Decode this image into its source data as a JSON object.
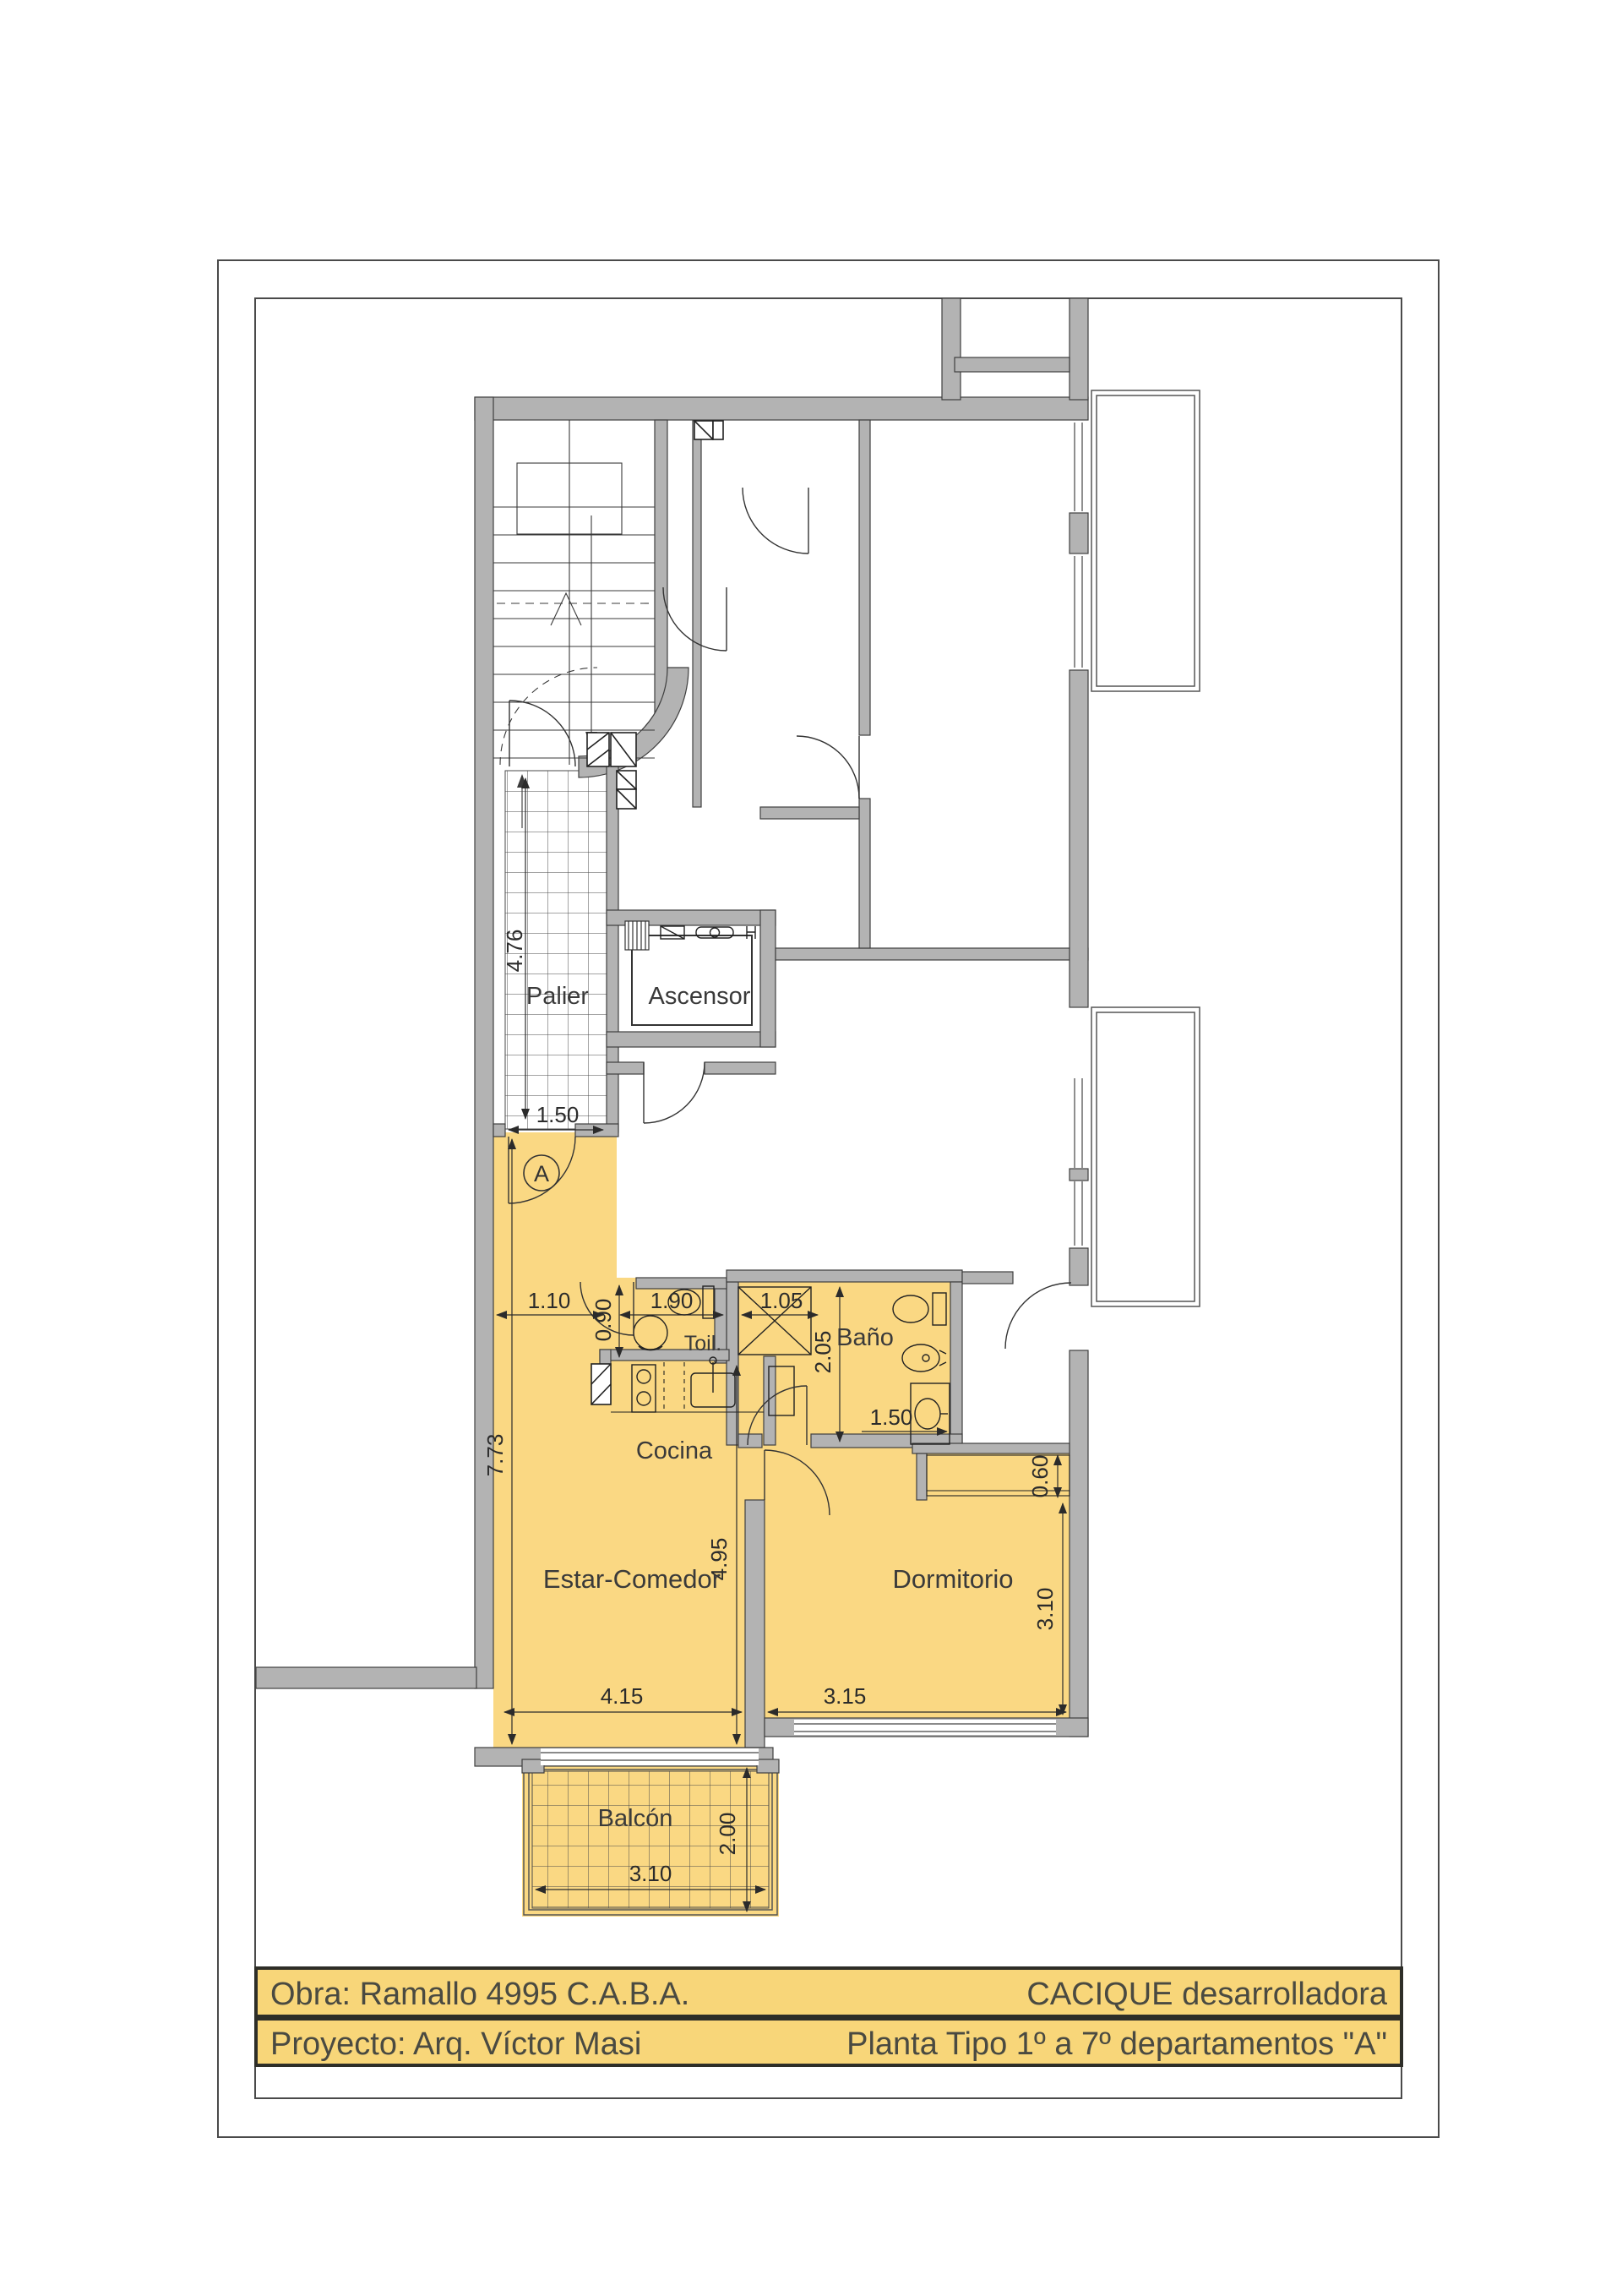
{
  "title_block": {
    "rows": [
      {
        "left": "Obra: Ramallo 4995 C.A.B.A.",
        "right": "CACIQUE desarrolladora"
      },
      {
        "left": "Proyecto: Arq. Víctor Masi",
        "right": "Planta Tipo 1º a 7º  departamentos \"A\""
      }
    ]
  },
  "plan": {
    "marker": "A",
    "rooms": {
      "palier": "Palier",
      "ascensor": "Ascensor",
      "toil": "Toil.",
      "bano": "Baño",
      "cocina": "Cocina",
      "estar": "Estar-Comedor",
      "dormitorio": "Dormitorio",
      "balcon": "Balcón"
    },
    "dimensions": {
      "palier_length": "4.76",
      "palier_width": "1.50",
      "entry_width": "1.10",
      "toil_door": "0.90",
      "toil_width": "1.90",
      "shower_width": "1.05",
      "bano_length": "2.05",
      "bano_width": "1.50",
      "closet_depth": "0.60",
      "apartment_length": "7.73",
      "estar_length": "4.95",
      "dorm_length": "3.10",
      "estar_width": "4.15",
      "dorm_width": "3.15",
      "balcon_depth": "2.00",
      "balcon_width": "3.10"
    }
  },
  "colors": {
    "apartment_fill": "#FAD883",
    "wall_fill": "#B3B3B3",
    "wall_stroke": "#3C3C3C",
    "title_fill": "#F8D679",
    "line": "#2B2B2B",
    "text": "#3A3A35"
  }
}
